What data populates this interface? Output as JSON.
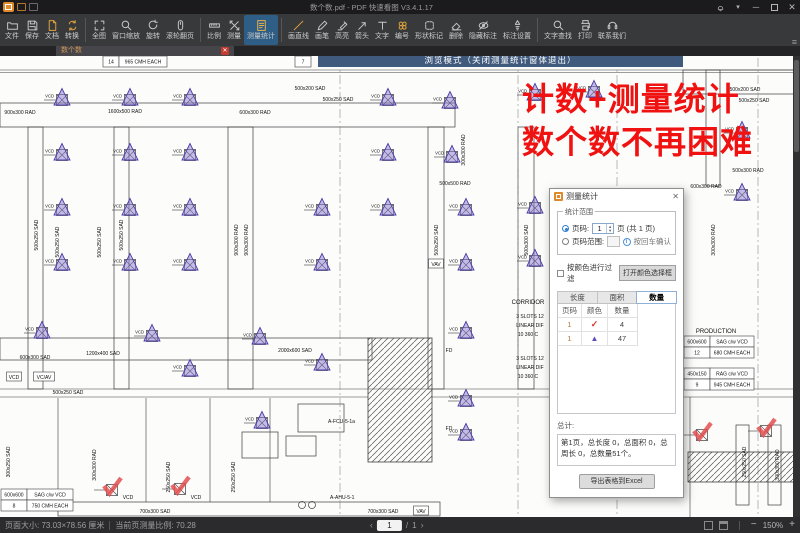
{
  "window": {
    "title": "数个数.pdf - PDF 快速看图 V3.4.1.17"
  },
  "tab": {
    "label": "数个数"
  },
  "notice": {
    "text": "浏览模式（关闭测量统计窗体退出）",
    "bg": "#3f5a7d"
  },
  "overlay": {
    "line1": "计数+测量统计",
    "line2": "数个数不再困难",
    "color": "#f01111"
  },
  "toolbar": {
    "groups": [
      {
        "items": [
          {
            "label": "文件",
            "icon": "folder"
          },
          {
            "label": "保存",
            "icon": "save"
          },
          {
            "label": "文档",
            "icon": "doc",
            "accent": true
          },
          {
            "label": "转换",
            "icon": "convert",
            "accent": true
          }
        ]
      },
      {
        "items": [
          {
            "label": "全图",
            "icon": "fit"
          },
          {
            "label": "窗口缩放",
            "icon": "zoomwin"
          },
          {
            "label": "旋转",
            "icon": "rotate"
          },
          {
            "label": "滚轮翻页",
            "icon": "mouse"
          }
        ]
      },
      {
        "items": [
          {
            "label": "比例",
            "icon": "scale"
          },
          {
            "label": "测量",
            "icon": "measure"
          },
          {
            "label": "测量统计",
            "icon": "stats",
            "accent": true,
            "active": true
          }
        ]
      },
      {
        "items": [
          {
            "label": "画直线",
            "icon": "line",
            "accent": true
          },
          {
            "label": "画笔",
            "icon": "pen"
          },
          {
            "label": "高亮",
            "icon": "highlight"
          },
          {
            "label": "箭头",
            "icon": "arrow"
          },
          {
            "label": "文字",
            "icon": "text"
          },
          {
            "label": "编号",
            "icon": "number",
            "accent": true
          },
          {
            "label": "形状标记",
            "icon": "shape"
          },
          {
            "label": "删除",
            "icon": "erase"
          },
          {
            "label": "隐藏标注",
            "icon": "hide"
          },
          {
            "label": "标注设置",
            "icon": "annoset"
          }
        ]
      },
      {
        "items": [
          {
            "label": "文字查找",
            "icon": "search"
          },
          {
            "label": "打印",
            "icon": "print"
          },
          {
            "label": "联系我们",
            "icon": "contact"
          }
        ]
      }
    ]
  },
  "panel": {
    "title": "测量统计",
    "close": "✕",
    "range": {
      "legend": "统计范围",
      "page_radio": "页码:",
      "page_value": "1",
      "page_suffix": "页 (共 1 页)",
      "range_radio": "页码范围:",
      "confirm_hint": "按回车确认"
    },
    "filter": {
      "checkbox": "按颜色进行过滤",
      "button": "打开颜色选择框"
    },
    "tabs": [
      {
        "label": "长度",
        "active": false
      },
      {
        "label": "面积",
        "active": false
      },
      {
        "label": "数量",
        "active": true
      }
    ],
    "table": {
      "headers": [
        "页码",
        "颜色",
        "数量"
      ],
      "rows": [
        {
          "page": "1",
          "marker": "check",
          "count": "4"
        },
        {
          "page": "1",
          "marker": "triangle",
          "count": "47"
        }
      ]
    },
    "total_label": "总计:",
    "total_text": "第1页，总长度 0，总面积 0，总周长 0，总数量51个。",
    "export_button": "导出表格到Excel"
  },
  "status": {
    "page_size": "页面大小: 73.03×78.56 厘米",
    "scale": "当前页测量比例: 70.28",
    "page_current": "1",
    "page_total": "1",
    "zoom": "150%"
  },
  "blueprint": {
    "colors": {
      "triangle_fill": "#8b7ad1",
      "triangle_stroke": "#4a3da5",
      "check": "#e34f4f",
      "ink": "#3c3c3c"
    },
    "triangles": [
      [
        62,
        97
      ],
      [
        130,
        97
      ],
      [
        190,
        97
      ],
      [
        388,
        97
      ],
      [
        450,
        100
      ],
      [
        535,
        92
      ],
      [
        594,
        89
      ],
      [
        62,
        152
      ],
      [
        130,
        152
      ],
      [
        190,
        152
      ],
      [
        388,
        152
      ],
      [
        452,
        154
      ],
      [
        62,
        207
      ],
      [
        130,
        207
      ],
      [
        190,
        207
      ],
      [
        322,
        207
      ],
      [
        388,
        207
      ],
      [
        466,
        207
      ],
      [
        535,
        205
      ],
      [
        62,
        262
      ],
      [
        130,
        262
      ],
      [
        190,
        262
      ],
      [
        322,
        262
      ],
      [
        466,
        262
      ],
      [
        535,
        258
      ],
      [
        42,
        330
      ],
      [
        152,
        333
      ],
      [
        260,
        336
      ],
      [
        466,
        330
      ],
      [
        190,
        368
      ],
      [
        322,
        362
      ],
      [
        262,
        420
      ],
      [
        466,
        398
      ],
      [
        466,
        432
      ],
      [
        742,
        130
      ],
      [
        742,
        192
      ]
    ],
    "checks": [
      [
        112,
        487
      ],
      [
        180,
        486
      ],
      [
        702,
        432
      ],
      [
        766,
        428
      ]
    ],
    "labels": [
      {
        "t": "900x300 RAD",
        "x": 20,
        "y": 112
      },
      {
        "t": "1600x500 RAD",
        "x": 125,
        "y": 111
      },
      {
        "t": "600x300 RAD",
        "x": 255,
        "y": 112
      },
      {
        "t": "500x200 SAD",
        "x": 310,
        "y": 88
      },
      {
        "t": "500x250 SAD",
        "x": 338,
        "y": 99
      },
      {
        "t": "300x300 RAD",
        "x": 463,
        "y": 150,
        "r": 1
      },
      {
        "t": "500x500 RAD",
        "x": 455,
        "y": 183
      },
      {
        "t": "500x200 SAD",
        "x": 745,
        "y": 89
      },
      {
        "t": "500x250 SAD",
        "x": 754,
        "y": 100
      },
      {
        "t": "500x300 RAD",
        "x": 748,
        "y": 170
      },
      {
        "t": "600x300 RAD",
        "x": 706,
        "y": 186
      },
      {
        "t": "300x300 RAD",
        "x": 713,
        "y": 240,
        "r": 1
      },
      {
        "t": "500x250 SAD",
        "x": 36,
        "y": 235,
        "r": 1
      },
      {
        "t": "500x250 SAD",
        "x": 57,
        "y": 242,
        "r": 1
      },
      {
        "t": "500x250 SAD",
        "x": 99,
        "y": 242,
        "r": 1
      },
      {
        "t": "500x250 SAD",
        "x": 121,
        "y": 235,
        "r": 1
      },
      {
        "t": "900x300 RAD",
        "x": 236,
        "y": 240,
        "r": 1
      },
      {
        "t": "900x300 RAD",
        "x": 246,
        "y": 240,
        "r": 1
      },
      {
        "t": "500x250 SAD",
        "x": 436,
        "y": 240,
        "r": 1
      },
      {
        "t": "500x300 SAD",
        "x": 526,
        "y": 240,
        "r": 1
      },
      {
        "t": "600x300 SAD",
        "x": 35,
        "y": 357
      },
      {
        "t": "1200x400 SAD",
        "x": 103,
        "y": 353
      },
      {
        "t": "2000x600 SAD",
        "x": 295,
        "y": 350
      },
      {
        "t": "500x250 SAD",
        "x": 68,
        "y": 392
      },
      {
        "t": "VCD",
        "x": 14,
        "y": 377,
        "box": 1
      },
      {
        "t": "VC/AV",
        "x": 44,
        "y": 377,
        "box": 1
      },
      {
        "t": "VAV",
        "x": 436,
        "y": 264,
        "box": 1
      },
      {
        "t": "FD",
        "x": 449,
        "y": 350
      },
      {
        "t": "FD",
        "x": 449,
        "y": 428
      },
      {
        "t": "A-FCU-5-1a",
        "x": 328,
        "y": 421,
        "a": "s"
      },
      {
        "t": "A-AHU-5-1",
        "x": 330,
        "y": 497,
        "a": "s"
      },
      {
        "t": "CORRIDOR",
        "x": 528,
        "y": 302,
        "s": 6
      },
      {
        "t": "PRODUCTION",
        "x": 716,
        "y": 331,
        "s": 6
      },
      {
        "t": "3 SLOTS 12",
        "x": 530,
        "y": 316
      },
      {
        "t": "LINEAR DIF",
        "x": 530,
        "y": 325
      },
      {
        "t": "10  360 C",
        "x": 528,
        "y": 334
      },
      {
        "t": "3 SLOTS 12",
        "x": 530,
        "y": 358
      },
      {
        "t": "LINEAR DIF",
        "x": 530,
        "y": 367
      },
      {
        "t": "10  360 C",
        "x": 528,
        "y": 376
      },
      {
        "t": "300x300 RAD",
        "x": 94,
        "y": 465,
        "r": 1
      },
      {
        "t": "250x250 SAD",
        "x": 168,
        "y": 477,
        "r": 1
      },
      {
        "t": "250x250 SAD",
        "x": 233,
        "y": 477,
        "r": 1
      },
      {
        "t": "300x250 SAD",
        "x": 8,
        "y": 462,
        "r": 1
      },
      {
        "t": "250x250 SAD",
        "x": 744,
        "y": 462,
        "r": 1
      },
      {
        "t": "300x300 RAD",
        "x": 777,
        "y": 465,
        "r": 1
      },
      {
        "t": "700x300 SAD",
        "x": 155,
        "y": 511
      },
      {
        "t": "700x300 SAD",
        "x": 383,
        "y": 511
      },
      {
        "t": "VAV",
        "x": 421,
        "y": 511,
        "box": 1
      },
      {
        "t": "VCD",
        "x": 128,
        "y": 497
      },
      {
        "t": "VCD",
        "x": 196,
        "y": 497
      }
    ],
    "tables": [
      {
        "x": 103,
        "y": 56,
        "rh": 11,
        "cols": [
          16,
          48
        ],
        "rows": [
          [
            "14",
            "965 CMH EACH"
          ]
        ]
      },
      {
        "x": 295,
        "y": 56,
        "rh": 11,
        "cols": [
          16
        ],
        "rows": [
          [
            "7"
          ]
        ]
      },
      {
        "x": 1,
        "y": 489,
        "rh": 11,
        "cols": [
          26,
          46
        ],
        "rows": [
          [
            "600x600",
            "SAG c/w VCD"
          ],
          [
            "8",
            "750 CMH EACH"
          ]
        ]
      },
      {
        "x": 684,
        "y": 336,
        "rh": 11,
        "cols": [
          26,
          44
        ],
        "rows": [
          [
            "600x600",
            "SAG c/w VCD"
          ],
          [
            "12",
            "680 CMH EACH"
          ]
        ]
      },
      {
        "x": 684,
        "y": 368,
        "rh": 11,
        "cols": [
          26,
          44
        ],
        "rows": [
          [
            "450x150",
            "RAG c/w VCD"
          ],
          [
            "9",
            "945 CMH EACH"
          ]
        ]
      }
    ]
  }
}
